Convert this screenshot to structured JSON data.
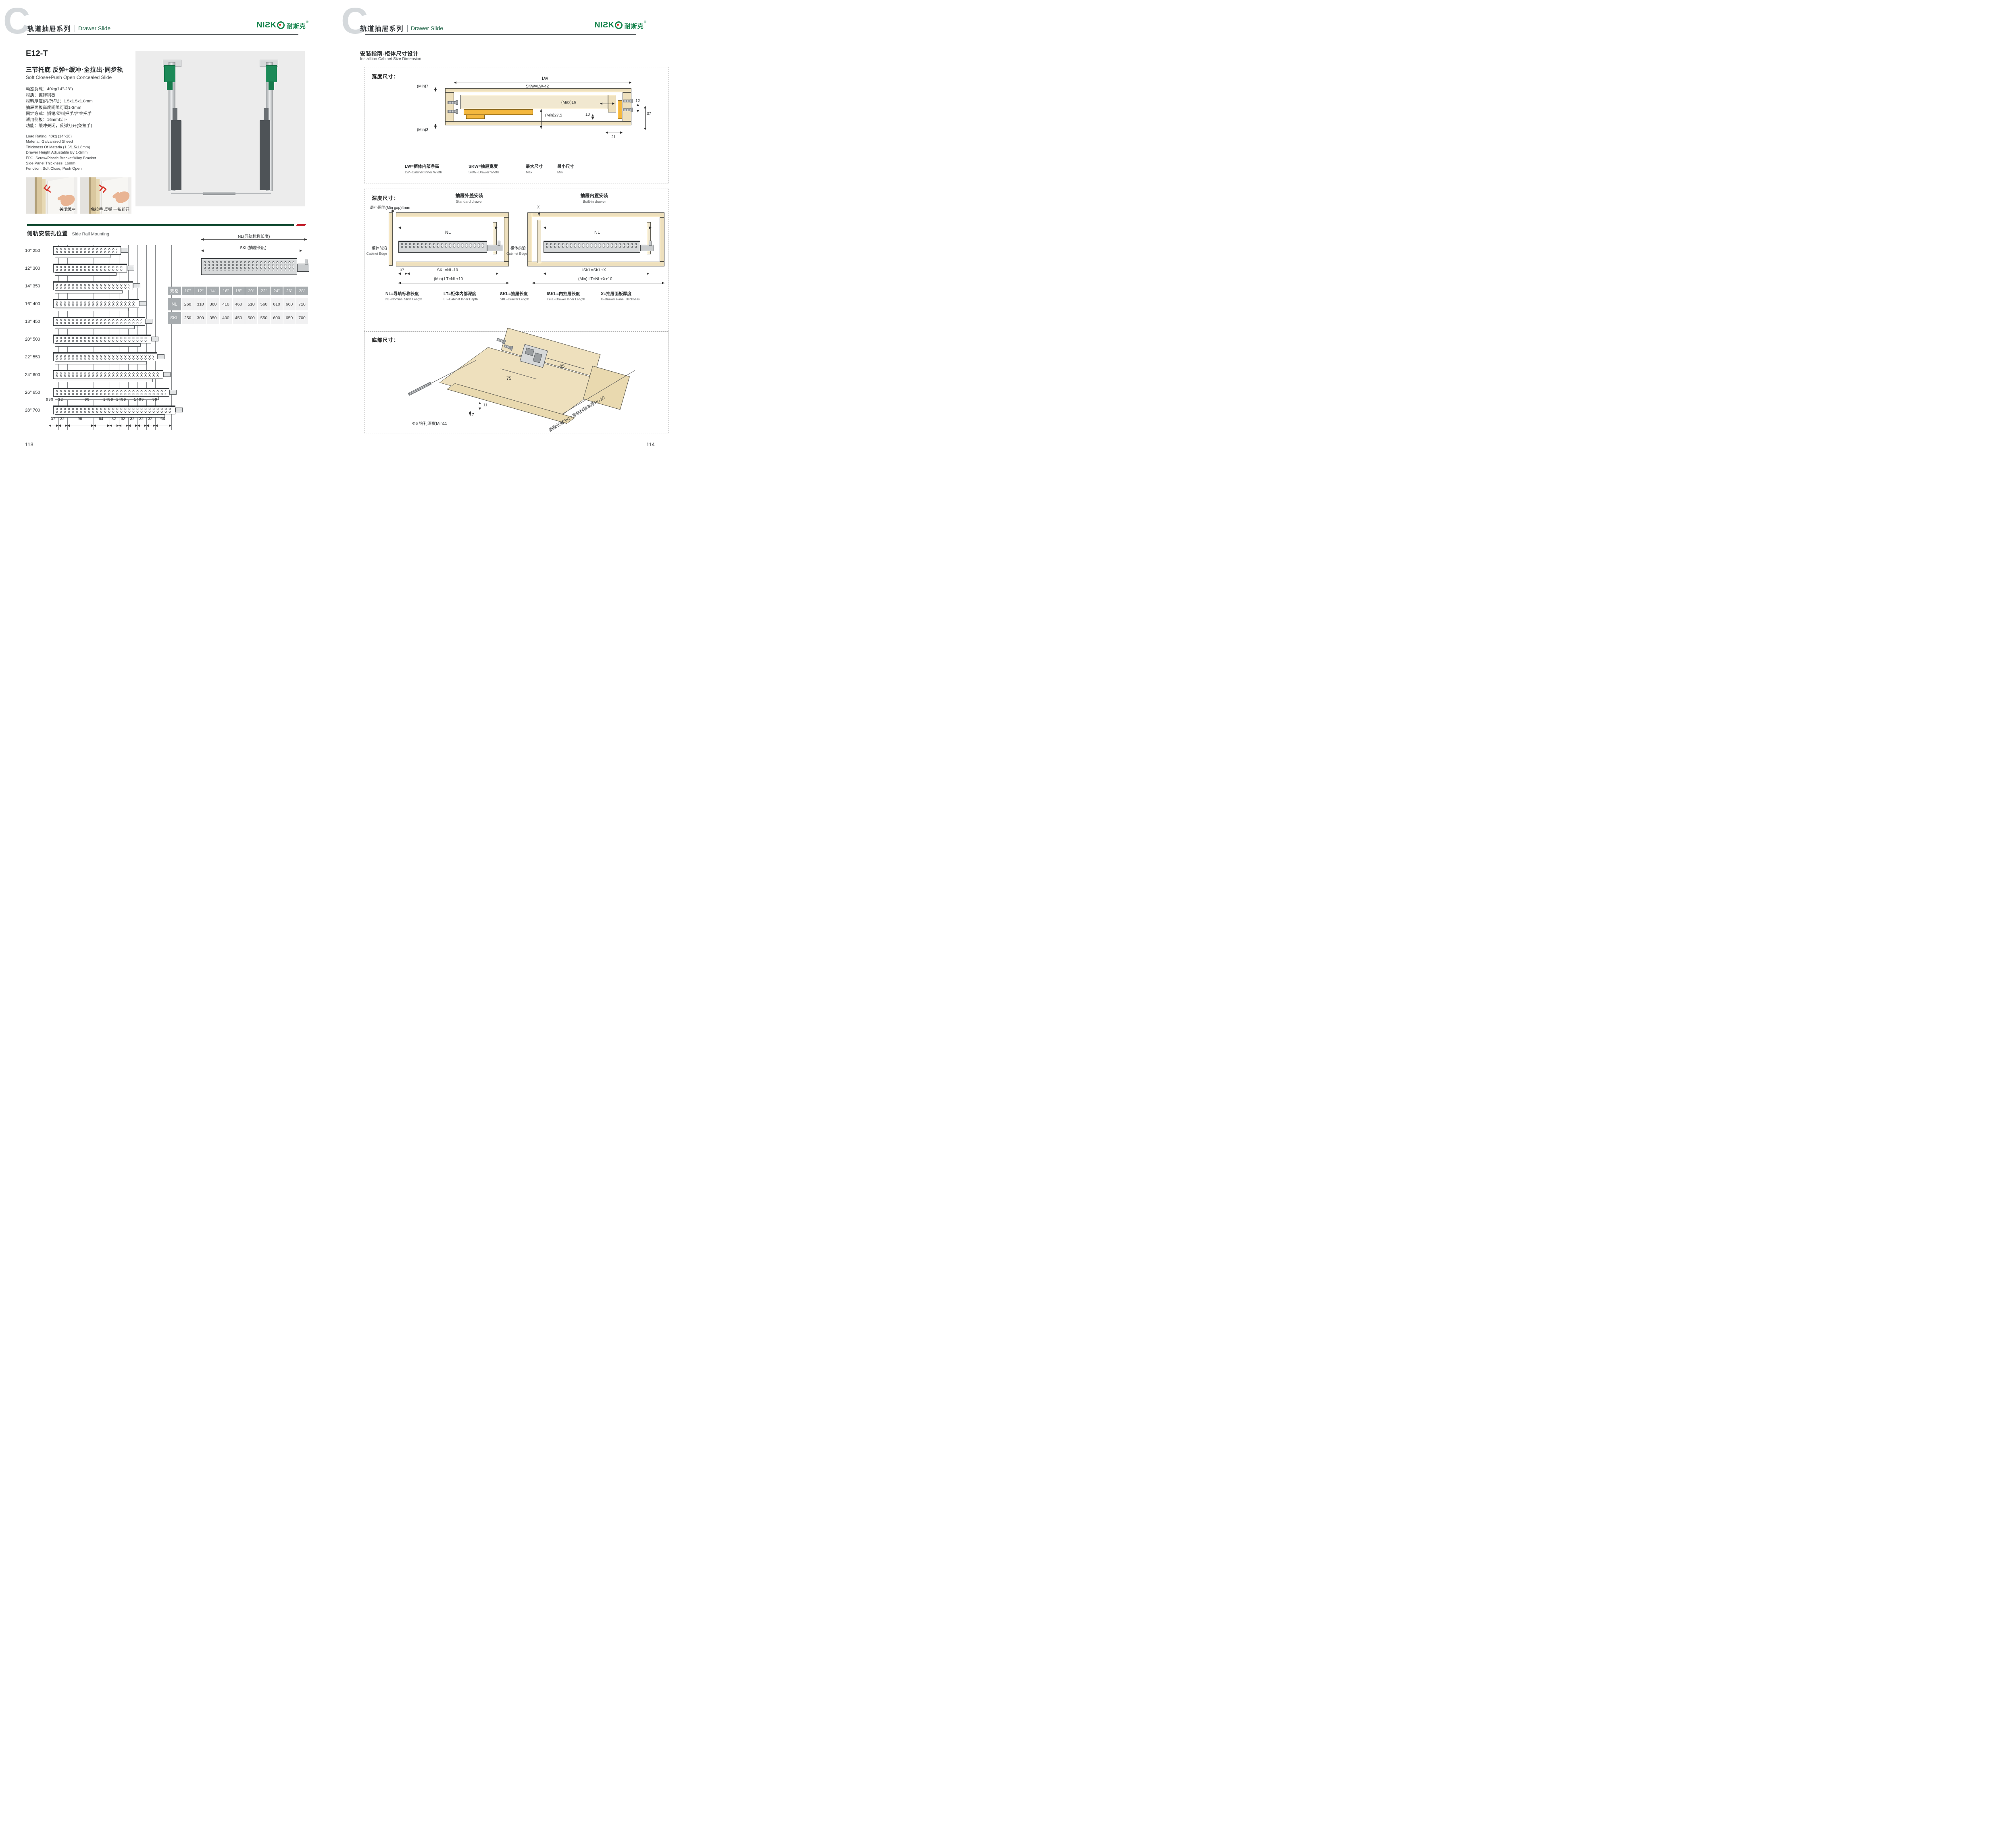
{
  "header": {
    "letter": "C",
    "series_cn": "轨道抽屉系列",
    "series_en": "Drawer Slide"
  },
  "brand": {
    "logo_text": "NIƧK",
    "logo_cn": "耐斯克",
    "reg": "®"
  },
  "left_page": {
    "model": "E12-T",
    "title_cn": "三节托底 反弹+缓冲·全拉出·同步轨",
    "title_en": "Soft Close+Push Open Concealed Slide",
    "specs_cn": [
      "动态负载：40kg(14\"-28\")",
      "材质：镀锌钢板",
      "材料厚度(内/外轨)：1.5x1.5x1.8mm",
      "抽屉面板高度间隙可调1-3mm",
      "固定方式：插销/塑料把手/合金把手",
      "适用侧板：16mm以下",
      "功能：缓冲关闭，反弹打开(免拉手)"
    ],
    "specs_en": [
      "Load Rating: 40kg (14\"-28)",
      "Material: Galvanized Sheed",
      "Thickness Of Materia (1.5/1.5/1.8mm)",
      "Drawer Height Adjustable By 1-3mm",
      "FIX：Screw/Plastic Bracket/Alloy Bracket",
      "Side Panel Thickness: 16mm",
      "Function: Soft Close, Push Open"
    ],
    "photos": [
      {
        "caption": "关闭缓冲",
        "arrow_icon": "chevrons-left"
      },
      {
        "caption": "免拉手 反弹 一按即开",
        "arrow_icon": "chevrons-right"
      }
    ],
    "side_rail": {
      "title_cn": "侧轨安装孔位置",
      "title_en": "Side Rail Mounting",
      "nl_label": "NL(导轨标称长度)",
      "skl_label": "SKL(抽屉长度)",
      "rows": [
        "10\" 250",
        "12\" 300",
        "14\" 350",
        "16\" 400",
        "18\" 450",
        "20\" 500",
        "22\" 550",
        "24\" 600",
        "26\" 650",
        "28\" 700"
      ],
      "top_dims": [
        "999",
        "32",
        "99",
        "1499",
        "1499",
        "1499",
        "99"
      ],
      "bottom_dims": [
        "37",
        "32",
        "96",
        "64",
        "32",
        "32",
        "32",
        "32",
        "32",
        "64"
      ],
      "table": {
        "header": [
          "规格",
          "10\"",
          "12\"",
          "14\"",
          "16\"",
          "18\"",
          "20\"",
          "22\"",
          "24\"",
          "26\"",
          "28\""
        ],
        "rows": [
          {
            "label": "NL",
            "values": [
              "260",
              "310",
              "360",
              "410",
              "460",
              "510",
              "560",
              "610",
              "660",
              "710"
            ]
          },
          {
            "label": "SKL",
            "values": [
              "250",
              "300",
              "350",
              "400",
              "450",
              "500",
              "550",
              "600",
              "650",
              "700"
            ]
          }
        ]
      }
    },
    "page_number": "113"
  },
  "right_page": {
    "guide_title_cn": "安装指南-柜体尺寸设计",
    "guide_title_en": "Installtion Cabinet Size Dimension",
    "width_box": {
      "label": "宽度尺寸：",
      "lw": "LW",
      "skw": "SKW=LW-42",
      "min7": "(Min)7",
      "max16": "(Max)16",
      "d12": "12",
      "d10": "10",
      "d37": "37",
      "min27": "(Min)27.5",
      "min3": "(Min)3",
      "d21": "21",
      "legend": [
        {
          "cn": "LW=柜体内部净高",
          "en": "LW=Cabinet Inner Width"
        },
        {
          "cn": "SKW=抽屉宽度",
          "en": "SKW=Drawer Width"
        },
        {
          "cn": "最大尺寸",
          "en": "Max"
        },
        {
          "cn": "最小尺寸",
          "en": "Min"
        }
      ]
    },
    "depth_box": {
      "label": "深度尺寸：",
      "min_gap": "最小间隙(Min gap)4mm",
      "standard": {
        "title_cn": "抽屉外盖安装",
        "title_en": "Standard drawer",
        "nl": "NL",
        "d37": "37",
        "skl": "SKL=NL-10",
        "lt": "(Min) LT=NL+10",
        "edge_cn": "柜体前沿",
        "edge_en": "Cabinet Edge"
      },
      "builtin": {
        "title_cn": "抽屉内置安装",
        "title_en": "Built-in drawer",
        "x": "X",
        "nl": "NL",
        "iskl": "ISKL=SKL+X",
        "lt": "(Min) LT=NL+X+10",
        "edge_cn": "柜体前沿",
        "edge_en": "Cabinet Edge"
      },
      "legend": [
        {
          "cn": "NL=导轨标称长度",
          "en": "NL=Nominal Slide Length"
        },
        {
          "cn": "LT=柜体内部深度",
          "en": "LT=Cabinet Inner Depth"
        },
        {
          "cn": "SKL=抽屉长度",
          "en": "SKL=Drawer Length"
        },
        {
          "cn": "ISKL=内抽屉长度",
          "en": "ISKL=Drawer Inner Length"
        },
        {
          "cn": "X=抽屉面板厚度",
          "en": "X=Drawer Panel Thickness"
        }
      ]
    },
    "bottom_box": {
      "label": "底部尺寸：",
      "d75": "75",
      "d85": "85",
      "d11": "11",
      "d7": "7",
      "drill": "Φ6 钻孔深度Min11",
      "skl_note": "抽屉长度SKL=导轨标称长度NL-10"
    },
    "page_number": "114"
  },
  "colors": {
    "brand_green": "#12824a",
    "logo_red": "#e02822",
    "bar_green": "#174f36",
    "bar_red": "#c3242f",
    "wood": "#eee0bd",
    "hardware_orange": "#f4b83e"
  }
}
